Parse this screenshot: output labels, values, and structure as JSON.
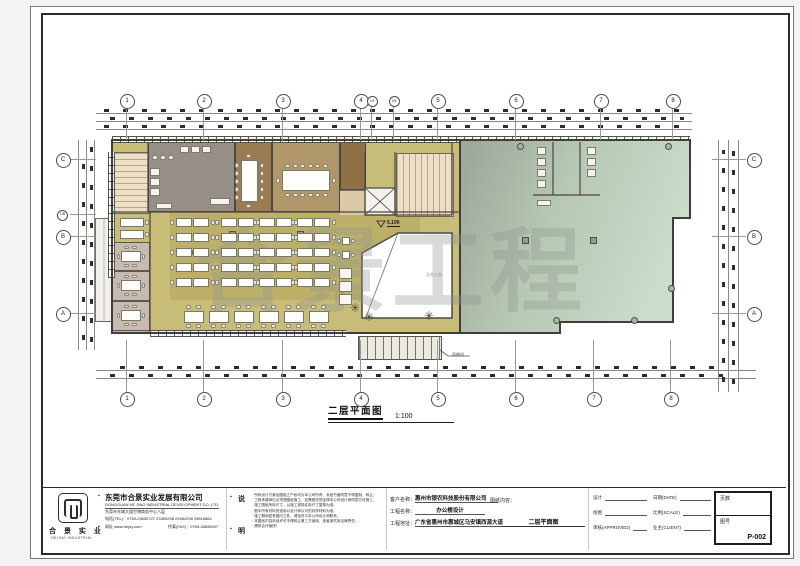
{
  "sheet": {
    "watermark": "合景工程",
    "plan_title": "二层平面图",
    "plan_scale": "1:100",
    "level_mark": "5.100",
    "atrium_label": "天井上空",
    "canopy_label": "雨棚线"
  },
  "grid": {
    "top": [
      "1",
      "2",
      "3",
      "4",
      "1/4",
      "2/4",
      "5",
      "6",
      "7",
      "8"
    ],
    "bottom": [
      "1",
      "2",
      "3",
      "4",
      "5",
      "6",
      "7",
      "8"
    ],
    "left": [
      "C",
      "1/B",
      "B",
      "A"
    ],
    "right": [
      "C",
      "B",
      "A"
    ]
  },
  "title_block": {
    "logo_name": "合 景 实 业",
    "logo_sub": "HEJING INDUSTRIAL",
    "company_cn": "东莞市合景实业发展有限公司",
    "company_en": "DONGGUAN HE JING INDUSTRIAL DEVELOPMENT CO.,LTD.",
    "company_addr": "东莞市东城大道世博商务中心八层",
    "company_tel": "电话(TEL)：0769-23630727  23369298  23364298  29816864",
    "company_web": "网址 www.hejoy.com",
    "company_fax": "传真(FAX)：0769-28656007",
    "notes_label_top": "说",
    "notes_label_bottom": "明",
    "notes": [
      "所有设计方案及图纸之产权均为本公司所有，未经书面同意不得复制、转让。",
      "工程承建单位必须按图纸施工，如需更改须征得本公司设计师同意方可施工。",
      "施工图纸所标尺寸，以施工现场实际尺寸复核为准。",
      "图中所有材料的选用以设计师认可的封样材料为准。",
      "施工期间如有疑问之处，请及时与本公司设计师联系。",
      "本图纸内容未经许可不得转让第三方使用，违者追究其法律责任。",
      "顺祝合作愉快！"
    ],
    "fields": {
      "client_label": "客户名称：",
      "client_value": "惠州市银农科技股份有限公司",
      "project_label": "工程名称：",
      "project_value": "办公楼设计",
      "address_label": "工程地址：",
      "address_value": "广东省惠州市惠城区马安镇西源大道",
      "content_label": "图纸内容：",
      "content_value": "二层平面图"
    },
    "sign": {
      "design": "设计",
      "draw": "绘图",
      "approve": "审核(APPROVED)",
      "date": "日期(DATE)",
      "scale": "比例(SCALE)",
      "client": "业主(CLIENT)"
    },
    "page_box": {
      "pages_label": "页数",
      "no_label": "图号",
      "no_value": "P-002"
    }
  }
}
